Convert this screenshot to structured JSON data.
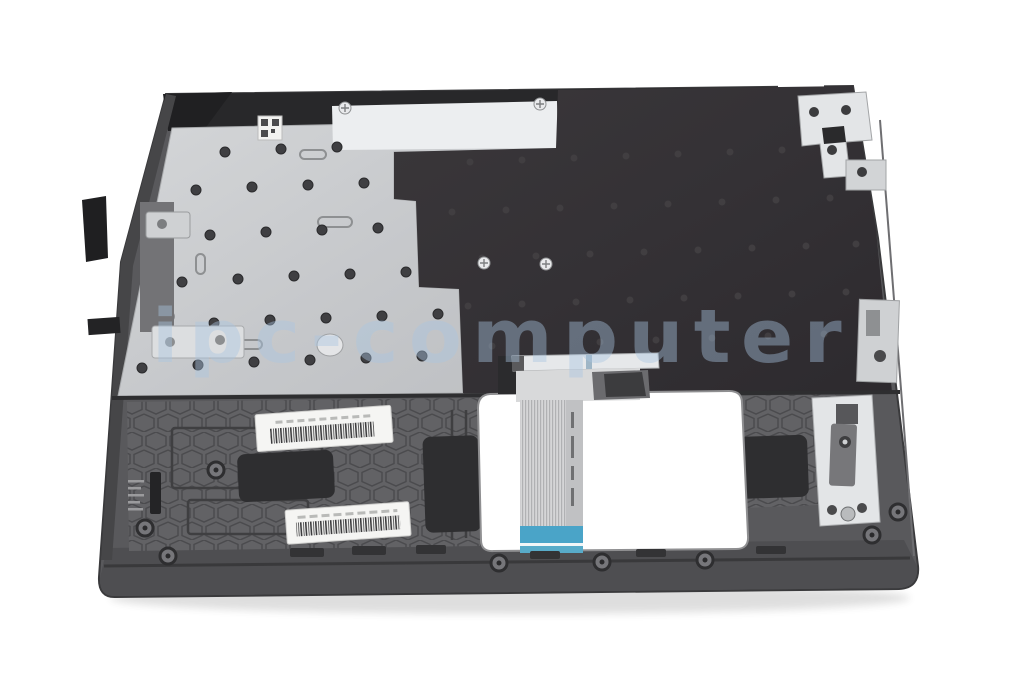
{
  "photo": {
    "description": "Laptop top case / palmrest with keyboard shown from the underside, keyboard flex ribbon cable hanging through the touchpad cutout, barcode stickers and foam pads on the housing",
    "background_color": "#ffffff"
  },
  "watermark": {
    "text": "ipc-computer",
    "color": "#aac6e2"
  },
  "part": {
    "colors": {
      "body_gray": "#59595c",
      "body_gray_dark": "#4e4e51",
      "top_rim_black": "#28282a",
      "keyboard_plate_silver": "#c9cbce",
      "plate_highlight": "#eceef0",
      "keyboard_membrane_black": "#353236",
      "honeycomb_gray": "#626265",
      "honeycomb_line": "#4b4b4e",
      "foam_pad_black": "#2e2e30",
      "sticker_white": "#f5f5f3",
      "barcode_ink": "#3c3c3e",
      "ribbon_gray": "#d5d6d7",
      "ribbon_stripe": "#b0b1b3",
      "ribbon_blue": "#4aa4c8",
      "bracket_silver": "#e3e5e7",
      "connector_bar_silver": "#e6e8ea",
      "cutout_white": "#ffffff",
      "shadow": "#3a3a3a"
    }
  }
}
